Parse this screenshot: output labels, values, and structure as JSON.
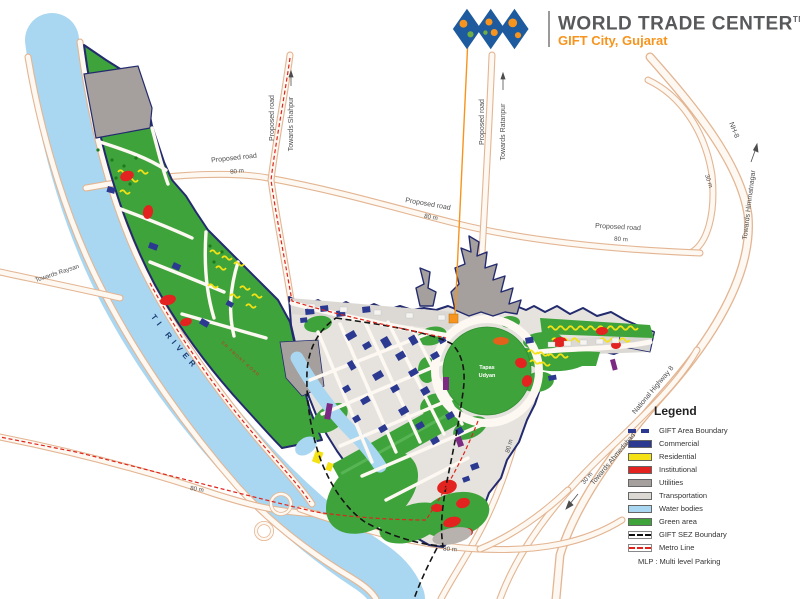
{
  "header": {
    "title": "WORLD TRADE CENTER",
    "trademark": "TM",
    "subtitle": "GIFT City, Gujarat",
    "brand_blue": "#1d5a9e",
    "brand_orange": "#f7941d",
    "title_color": "#58595b"
  },
  "map": {
    "labels": {
      "proposed_road_shahpur_v": "Proposed road",
      "towards_shahpur": "Towards Shahpur",
      "proposed_road_nw": "Proposed road",
      "dim_80m_nw": "80 m",
      "proposed_road_mid": "Proposed road",
      "dim_80m_mid": "80 m",
      "proposed_road_ratanpur_v": "Proposed road",
      "towards_ratanpur": "Towards Ratanpur",
      "proposed_road_east": "Proposed road",
      "dim_80m_east": "80 m",
      "nh8": "NH-8",
      "dim_30m_ne": "30 m",
      "towards_himmatnagar": "Towards Himmatnagar",
      "towards_raysan": "Towards Raysan",
      "national_highway_8": "National Highway 8",
      "towards_ahmedabad": "Towards Ahmedabad",
      "dim_30m_se": "30 m",
      "dim_80m_sw": "80 m",
      "dim_80m_south": "80 m",
      "dim_80m_south_v": "80 m",
      "sabarmati_river": "SABARMATI RIVER",
      "riverfront_road": "SABARMATI RIVER FRONT ROAD",
      "park_line1": "Tapas",
      "park_line2": "Udyan"
    },
    "colors": {
      "green_area": "#3fa33c",
      "water": "#a9d7f1",
      "road_edge": "#e3b593",
      "commercial": "#2b3990",
      "residential": "#f5e214",
      "institutional": "#e2231f",
      "utilities": "#a5a09d",
      "transportation": "#dcd9d5",
      "mlp_purple": "#7b2982",
      "metro_red": "#e0241b",
      "boundary_navy": "#232b6e",
      "callout_orange": "#f7941d"
    }
  },
  "legend": {
    "title": "Legend",
    "items": [
      {
        "label": "GIFT Area Boundary",
        "type": "dash",
        "color": "#2b3990"
      },
      {
        "label": "Commercial",
        "type": "fill",
        "color": "#2b3990"
      },
      {
        "label": "Residential",
        "type": "fill",
        "color": "#f5e214"
      },
      {
        "label": "Institutional",
        "type": "fill",
        "color": "#e2231f"
      },
      {
        "label": "Utilities",
        "type": "fill",
        "color": "#a5a09d"
      },
      {
        "label": "Transportation",
        "type": "fill",
        "color": "#dcd9d5"
      },
      {
        "label": "Water bodies",
        "type": "fill",
        "color": "#a9d7f1"
      },
      {
        "label": "Green area",
        "type": "fill",
        "color": "#3fa33c"
      },
      {
        "label": "GIFT SEZ Boundary",
        "type": "dash-sez",
        "color": "#111111"
      },
      {
        "label": "Metro Line",
        "type": "dash-metro",
        "color": "#e0241b"
      }
    ],
    "note": "MLP : Multi level Parking"
  }
}
